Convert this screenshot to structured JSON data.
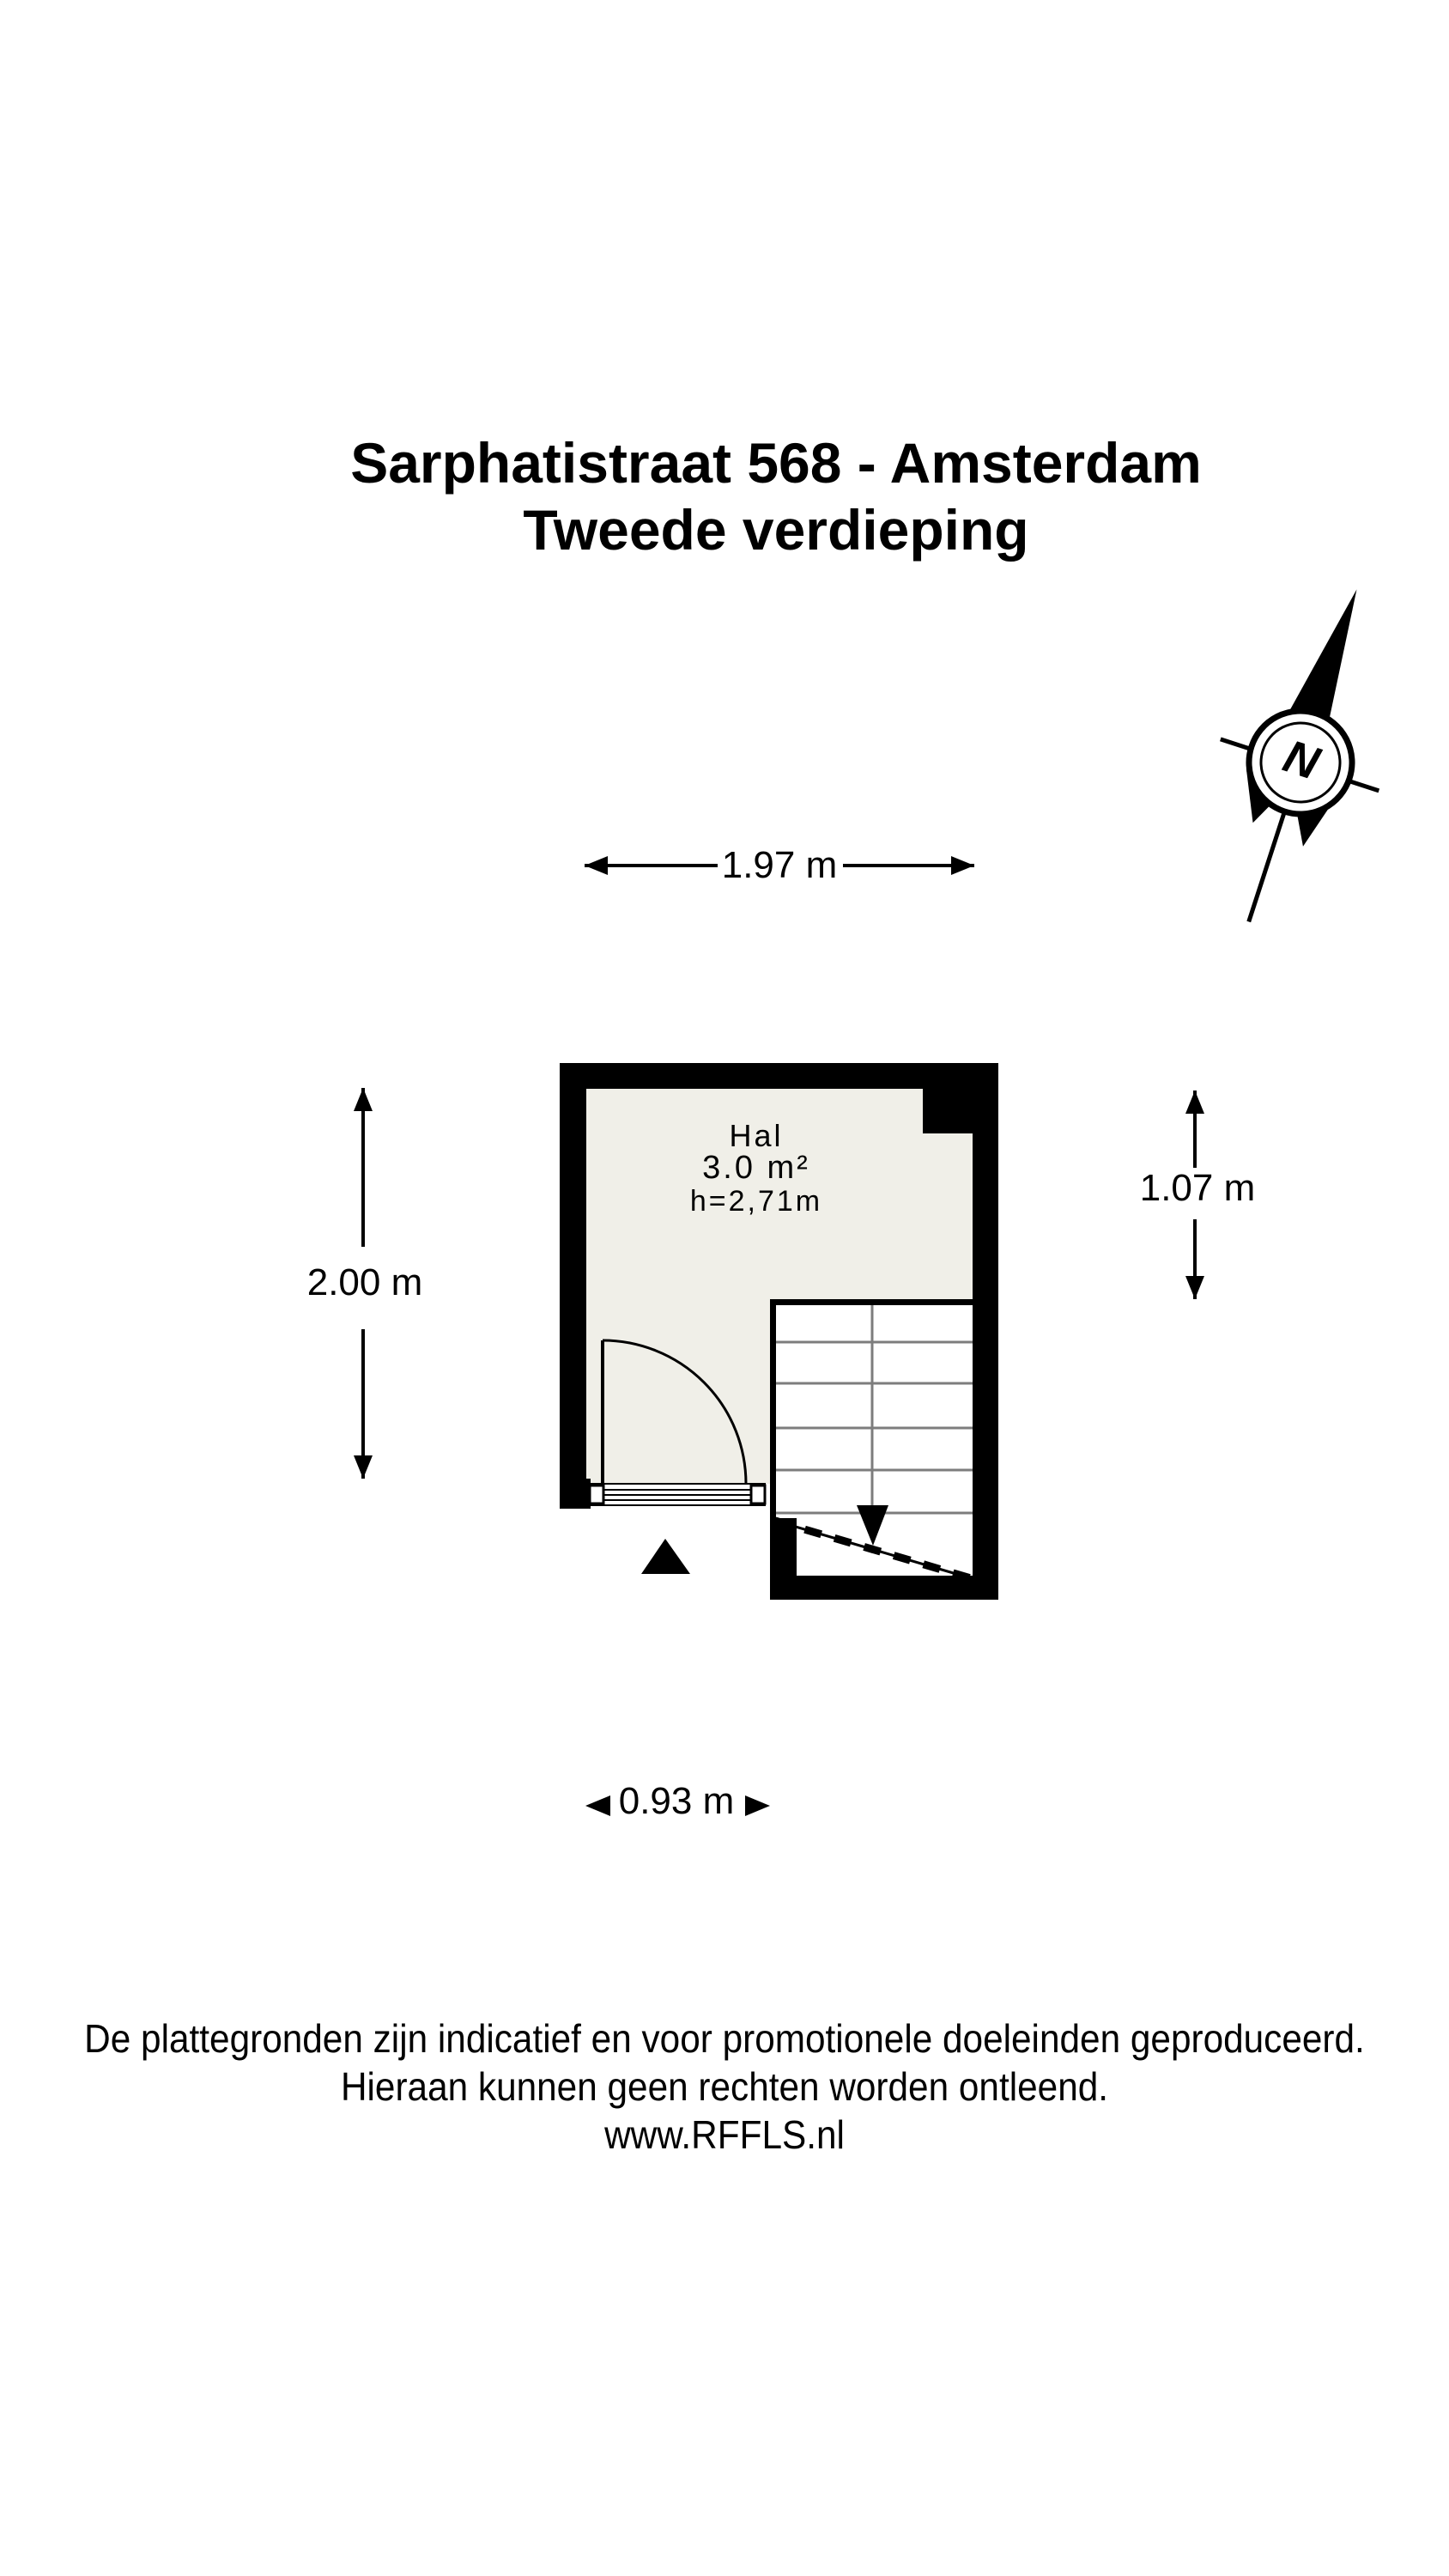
{
  "title": {
    "line1": "Sarphatistraat 568 - Amsterdam",
    "line2": "Tweede verdieping"
  },
  "compass": {
    "label": "N"
  },
  "room": {
    "name": "Hal",
    "area": "3.0 m²",
    "ceiling_height": "h=2,71m"
  },
  "dimensions": {
    "top": "1.97 m",
    "left": "2.00 m",
    "right": "1.07 m",
    "bottom": "0.93 m"
  },
  "footer": {
    "line1": "De plattegronden zijn indicatief en voor promotionele doeleinden geproduceerd.",
    "line2": "Hieraan kunnen geen rechten worden ontleend.",
    "line3": "www.RFFLS.nl"
  },
  "colors": {
    "wall": "#000000",
    "floor": "#f0efe8",
    "tread": "#7d7d7d",
    "background": "#ffffff"
  }
}
